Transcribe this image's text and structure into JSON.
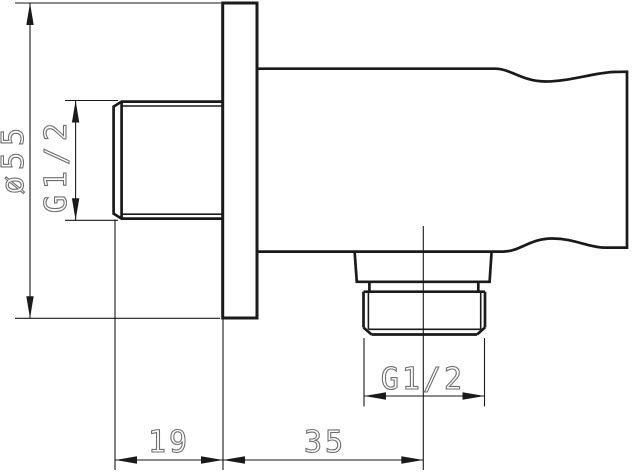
{
  "drawing": {
    "kind": "technical dimension drawing",
    "view": "side section of wall-mounted shower outlet elbow"
  },
  "dimensions": {
    "flange_diameter": {
      "label": "ø55"
    },
    "inlet_thread": {
      "label": "G1/2"
    },
    "outlet_thread": {
      "label": "G1/2"
    },
    "depth": {
      "label": "19"
    },
    "outlet_offset": {
      "label": "35"
    }
  },
  "colors": {
    "line": "#1a1a1a",
    "dimension_text": "#6f6f6f",
    "background": "#ffffff"
  }
}
